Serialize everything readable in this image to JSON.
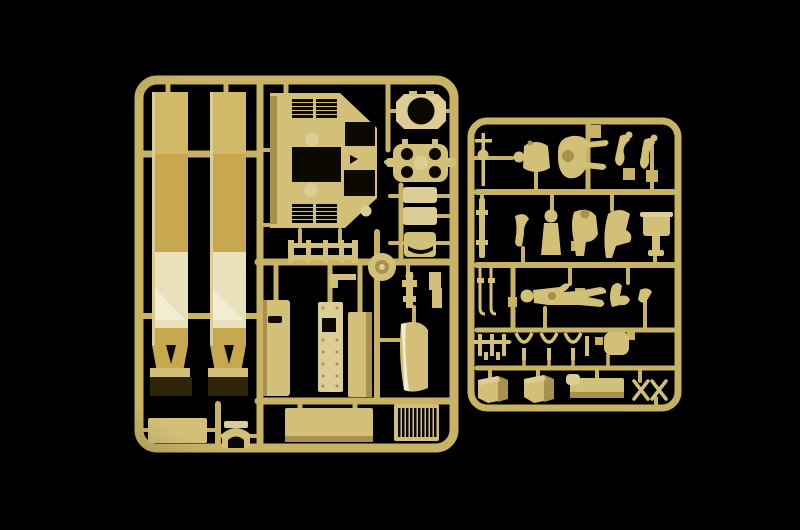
{
  "image": {
    "alt": "Photograph of two beige injection-molded plastic model kit sprues on a black background. The large left sprue holds two long track straps, an armored hull superstructure with louvered grilles, a round hatch ring, a clover hatch cover, seats, door panels, a fender and a radiator grille. The smaller right sprue holds crew figure parts, arms, tow rods, shackle chains, stowage boxes and scissor jacks.",
    "subject": "model-kit-sprue-photo"
  },
  "colors": {
    "background": "#000000",
    "rail": "#c8b365",
    "part": "#d3c078",
    "partLight": "#dccd96",
    "pale": "#e9e1bb",
    "paleHi": "#f2ecd2",
    "shade": "#a8914c",
    "strap": "#c7a84e",
    "strapTop": "#d2b968",
    "tip": "#2e2408",
    "hole": "#0c0903"
  },
  "sprues": [
    {
      "id": "left",
      "name": "large parts sprue",
      "parts": [
        "track strap left",
        "track strap right",
        "hull superstructure with louvres",
        "round hatch ring",
        "clover hatch cover",
        "bench frame",
        "idler wheel",
        "seat backrest",
        "seat cushion",
        "jack",
        "door panel",
        "riveted door panel",
        "side panel",
        "curved fender",
        "radiator grille",
        "floor plate",
        "lower hull plate",
        "wheel arch"
      ]
    },
    {
      "id": "right",
      "name": "figures and accessories sprue",
      "parts": [
        "gear lever",
        "figure torso",
        "reclining figure body",
        "figure arms pair",
        "tow rod",
        "crew figure",
        "seated figure",
        "cupola box",
        "tow cables",
        "standing figure",
        "chain links",
        "shackles",
        "seat pad",
        "stowage box",
        "tool box",
        "scissor jack"
      ]
    }
  ]
}
